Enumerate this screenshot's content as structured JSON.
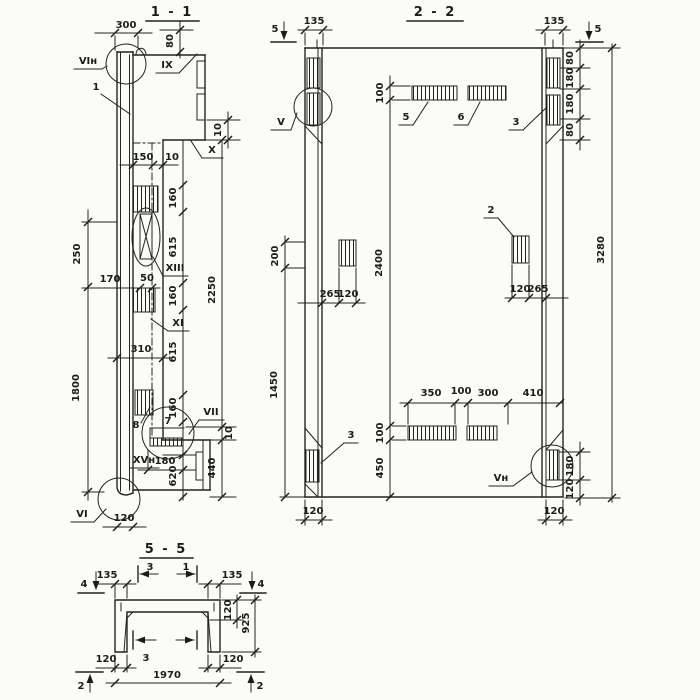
{
  "titles": {
    "s11": "1 - 1",
    "s22": "2 - 2",
    "s55": "5 - 5"
  },
  "s11": {
    "d300": "300",
    "d80": "80",
    "d10tr": "10",
    "d150": "150",
    "d10w": "10",
    "d160a": "160",
    "d615a": "615",
    "d160b": "160",
    "d615b": "615",
    "d160c": "160",
    "d620": "620",
    "d2250": "2250",
    "d10b": "10",
    "d440": "440",
    "d250": "250",
    "d1800": "1800",
    "d170": "170",
    "d50": "50",
    "d310": "310",
    "d180": "180",
    "d120": "120",
    "lVIn": "VIн",
    "lIX": "IX",
    "lX": "X",
    "lXIII": "XIII",
    "lXI": "XI",
    "lVII": "VII",
    "lXVn": "XVн",
    "lVI": "VI",
    "p1": "1",
    "p7": "7",
    "p8": "8"
  },
  "s22": {
    "cut5l": "5",
    "cut5r": "5",
    "d135l": "135",
    "d135r": "135",
    "d100t": "100",
    "d2400": "2400",
    "d100b": "100",
    "d450": "450",
    "d80a": "80",
    "d180a": "180",
    "d180b": "180",
    "d80b": "80",
    "d3280": "3280",
    "d200": "200",
    "d1450": "1450",
    "d265l": "265",
    "d120l": "120",
    "d120r": "120",
    "d265r": "265",
    "d350": "350",
    "d100m": "100",
    "d300": "300",
    "d410": "410",
    "d180br": "180",
    "d120br": "120",
    "d120bl": "120",
    "d120brr": "120",
    "lV": "V",
    "lVn": "Vн",
    "p2": "2",
    "p3t": "3",
    "p3b": "3",
    "p5": "5",
    "p6": "6"
  },
  "s55": {
    "cut4l": "4",
    "cut4r": "4",
    "cut3t": "3",
    "cut1t": "1",
    "cut3b": "3",
    "cut2l": "2",
    "cut2r": "2",
    "d135l": "135",
    "d135r": "135",
    "d120f": "120",
    "d925": "925",
    "d120bl": "120",
    "d120br": "120",
    "d1970": "1970"
  }
}
